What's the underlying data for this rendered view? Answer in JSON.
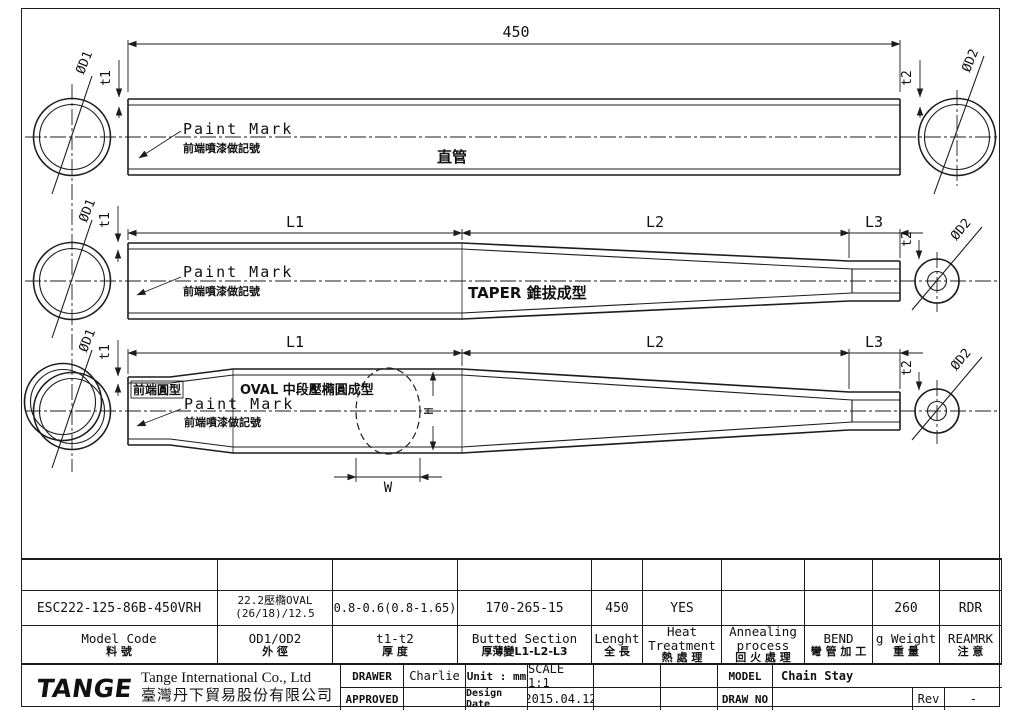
{
  "sheet": {
    "line_color": "#1c1c1c",
    "logo_green": "#2ea844"
  },
  "drawings": {
    "straight": {
      "length": "450",
      "t1": "t1",
      "t2": "t2",
      "od1": "ØD1",
      "od2": "ØD2",
      "paint_mark": "Paint Mark",
      "paint_mark_zh": "前端噴漆做記號",
      "type_zh": "直管"
    },
    "taper": {
      "l1": "L1",
      "l2": "L2",
      "l3": "L3",
      "t1": "t1",
      "t2": "t2",
      "od1": "ØD1",
      "od2": "ØD2",
      "paint_mark": "Paint Mark",
      "paint_mark_zh": "前端噴漆做記號",
      "type_label": "TAPER 錐拔成型"
    },
    "oval": {
      "l1": "L1",
      "l2": "L2",
      "l3": "L3",
      "t1": "t1",
      "t2": "t2",
      "od1": "ØD1",
      "od2": "ØD2",
      "paint_mark": "Paint Mark",
      "paint_mark_zh": "前端噴漆做記號",
      "front_zh": "前端圓型",
      "oval_label": "OVAL 中段壓橢圓成型",
      "width": "W",
      "height": "H"
    }
  },
  "spec_table": {
    "columns": [
      {
        "header_en": "Model Code",
        "header_zh": "料 號",
        "value": "ESC222-125-86B-450VRH"
      },
      {
        "header_en": "OD1/OD2",
        "header_zh": "外 徑",
        "value_line1": "22.2壓橢OVAL",
        "value_line2": "(26/18)/12.5"
      },
      {
        "header_en": "t1-t2",
        "header_zh": "厚 度",
        "value": "0.8-0.6(0.8-1.65)"
      },
      {
        "header_en": "Butted Section",
        "header_zh": "厚薄變L1-L2-L3",
        "value": "170-265-15"
      },
      {
        "header_en": "Lenght",
        "header_zh": "全 長",
        "value": "450"
      },
      {
        "header_en": "Heat Treatment",
        "header_zh": "熱 處 理",
        "value": "YES"
      },
      {
        "header_en": "Annealing process",
        "header_zh": "回 火 處 理",
        "value": ""
      },
      {
        "header_en": "BEND",
        "header_zh": "彎 管 加 工",
        "value": ""
      },
      {
        "header_en": "g Weight",
        "header_zh": "重 量",
        "value": "260"
      },
      {
        "header_en": "REAMRK",
        "header_zh": "注 意",
        "value": "RDR"
      }
    ]
  },
  "title_block": {
    "logo_text": "TANGE",
    "company_en": "Tange International Co., Ltd",
    "company_zh": "臺灣丹下貿易股份有限公司",
    "drawer_label": "DRAWER",
    "drawer": "Charlie",
    "approved_label": "APPROVED",
    "approved": "",
    "unit_label": "Unit : mm",
    "scale": "SCALE 1:1",
    "design_date_label": "Design Date",
    "design_date": "2015.04.12",
    "model_label": "MODEL",
    "model": "Chain Stay",
    "draw_no_label": "DRAW NO",
    "draw_no": "",
    "rev_label": "Rev",
    "rev": "-"
  }
}
